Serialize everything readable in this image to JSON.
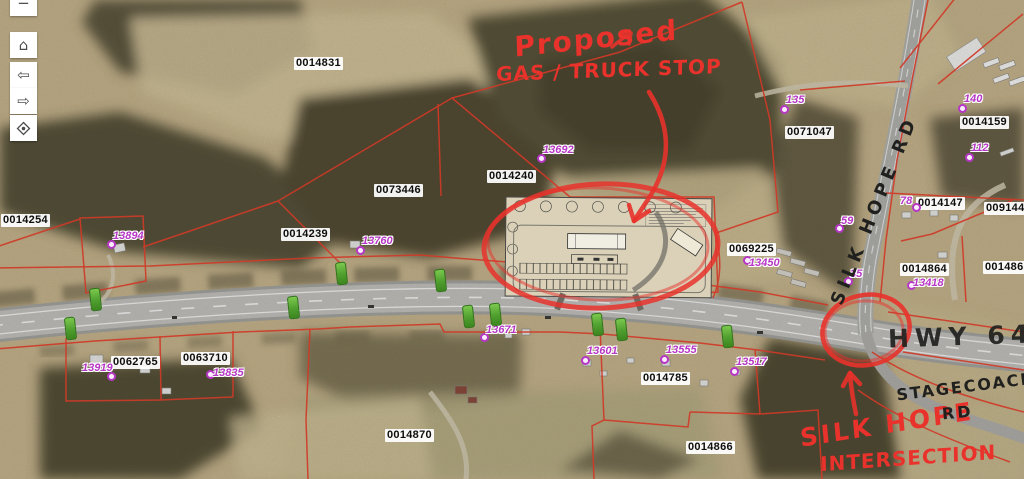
{
  "toolbar": {
    "buttons": [
      {
        "name": "zoom-out",
        "glyph": "−",
        "y": -10
      },
      {
        "name": "home",
        "glyph": "⌂",
        "y": 32
      },
      {
        "name": "previous-extent",
        "glyph": "⇦",
        "y": 62
      },
      {
        "name": "next-extent",
        "glyph": "⇨",
        "y": 88
      },
      {
        "name": "locate",
        "glyph": "",
        "y": 115
      }
    ]
  },
  "annotations": {
    "red_marker_color": "#e8322b",
    "black_marker_color": "#20201e",
    "proposed_line1": "Proposed",
    "proposed_line2": "GAS / TRUCK STOP",
    "intersection_line1": "SILK HOPE",
    "intersection_line2": "INTERSECTION"
  },
  "road_labels": {
    "silk_hope_rd": "SILK HOPE RD",
    "hwy_64": "HWY 64",
    "stagecoach_line1": "STAGECOACH",
    "stagecoach_line2": "RD"
  },
  "parcel_labels": [
    {
      "id": "0014831",
      "x": 294,
      "y": 57
    },
    {
      "id": "0014254",
      "x": 1,
      "y": 214
    },
    {
      "id": "0073446",
      "x": 374,
      "y": 184
    },
    {
      "id": "0014240",
      "x": 487,
      "y": 170
    },
    {
      "id": "0014239",
      "x": 281,
      "y": 228
    },
    {
      "id": "0062765",
      "x": 111,
      "y": 356
    },
    {
      "id": "0063710",
      "x": 181,
      "y": 352
    },
    {
      "id": "0014785",
      "x": 641,
      "y": 372
    },
    {
      "id": "0014870",
      "x": 385,
      "y": 429
    },
    {
      "id": "0014866",
      "x": 686,
      "y": 441
    },
    {
      "id": "0069225",
      "x": 727,
      "y": 243
    },
    {
      "id": "0071047",
      "x": 785,
      "y": 126
    },
    {
      "id": "0014159",
      "x": 960,
      "y": 116
    },
    {
      "id": "0014147",
      "x": 916,
      "y": 197
    },
    {
      "id": "0091445",
      "x": 984,
      "y": 202
    },
    {
      "id": "0014864",
      "x": 900,
      "y": 263
    },
    {
      "id": "0014865",
      "x": 983,
      "y": 261
    }
  ],
  "point_labels": [
    {
      "id": "13894",
      "tx": 113,
      "ty": 231,
      "dx": 107,
      "dy": 240
    },
    {
      "id": "13692",
      "tx": 543,
      "ty": 145,
      "dx": 537,
      "dy": 154
    },
    {
      "id": "13760",
      "tx": 362,
      "ty": 236,
      "dx": 356,
      "dy": 246
    },
    {
      "id": "13919",
      "tx": 82,
      "ty": 363,
      "dx": 107,
      "dy": 372
    },
    {
      "id": "13835",
      "tx": 213,
      "ty": 368,
      "dx": 206,
      "dy": 370
    },
    {
      "id": "13671",
      "tx": 486,
      "ty": 325,
      "dx": 480,
      "dy": 333
    },
    {
      "id": "13601",
      "tx": 587,
      "ty": 346,
      "dx": 581,
      "dy": 356
    },
    {
      "id": "13555",
      "tx": 666,
      "ty": 345,
      "dx": 660,
      "dy": 355
    },
    {
      "id": "13517",
      "tx": 736,
      "ty": 357,
      "dx": 730,
      "dy": 367
    },
    {
      "id": "13450",
      "tx": 749,
      "ty": 258,
      "dx": 743,
      "dy": 256
    },
    {
      "id": "13418",
      "tx": 913,
      "ty": 278,
      "dx": 907,
      "dy": 281
    },
    {
      "id": "135",
      "tx": 786,
      "ty": 95,
      "dx": 780,
      "dy": 105
    },
    {
      "id": "140",
      "tx": 964,
      "ty": 94,
      "dx": 958,
      "dy": 104
    },
    {
      "id": "112",
      "tx": 971,
      "ty": 143,
      "dx": 965,
      "dy": 153
    },
    {
      "id": "78",
      "tx": 900,
      "ty": 196,
      "dx": 912,
      "dy": 203
    },
    {
      "id": "59",
      "tx": 841,
      "ty": 216,
      "dx": 835,
      "dy": 224
    },
    {
      "id": "35",
      "tx": 850,
      "ty": 269,
      "dx": 844,
      "dy": 277
    }
  ],
  "markers": {
    "name": "green-road-marker",
    "color": "#4f9f2f",
    "positions": [
      [
        95,
        299
      ],
      [
        70,
        328
      ],
      [
        293,
        307
      ],
      [
        341,
        273
      ],
      [
        440,
        280
      ],
      [
        468,
        316
      ],
      [
        495,
        314
      ],
      [
        597,
        324
      ],
      [
        621,
        329
      ],
      [
        727,
        336
      ]
    ]
  },
  "colors": {
    "parcel_line": "#cf3a28",
    "point_label": "#b637c6",
    "field_tan": "#c9b78f",
    "forest": "#59533a",
    "road": "#c6c5c1"
  }
}
